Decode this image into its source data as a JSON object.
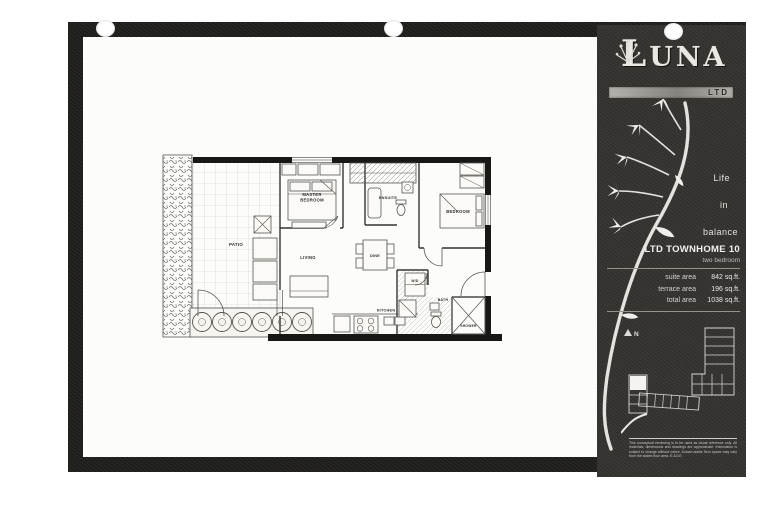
{
  "colors": {
    "frame": "#23221e",
    "panel": "#3a3834",
    "panel_text": "#e6e5e1",
    "plan_wall": "#181815",
    "highlight_unit": "#f4f3ef"
  },
  "header": {
    "brand": "LUNA",
    "brand_sub": "LTD"
  },
  "sidebar": {
    "tagline": {
      "line1": "Life",
      "line2": "in",
      "line3": "balance"
    },
    "unit": {
      "title": "LTD TOWNHOME 10",
      "subtitle": "two bedroom"
    },
    "areas": [
      {
        "label": "suite area",
        "value": "842 sq.ft."
      },
      {
        "label": "terrace area",
        "value": "196 sq.ft."
      },
      {
        "label": "total area",
        "value": "1038 sq.ft."
      }
    ],
    "north": "N",
    "disclaimer": "This conceptual rendering is to be used as visual reference only. All materials, dimensions and drawings are approximate. Information is subject to change without notice. Actual usable floor space may vary from the stated floor area. E.&O.E."
  },
  "floorplan": {
    "rooms": {
      "patio": "PATIO",
      "master_line1": "MASTER",
      "master_line2": "BEDROOM",
      "ensuite": "ENSUITE",
      "bedroom": "BEDROOM",
      "living": "LIVING",
      "dine": "DINE",
      "kitchen": "KITCHEN",
      "laundry": "W/D",
      "bath": "BATH",
      "shower": "SHOWER"
    }
  }
}
